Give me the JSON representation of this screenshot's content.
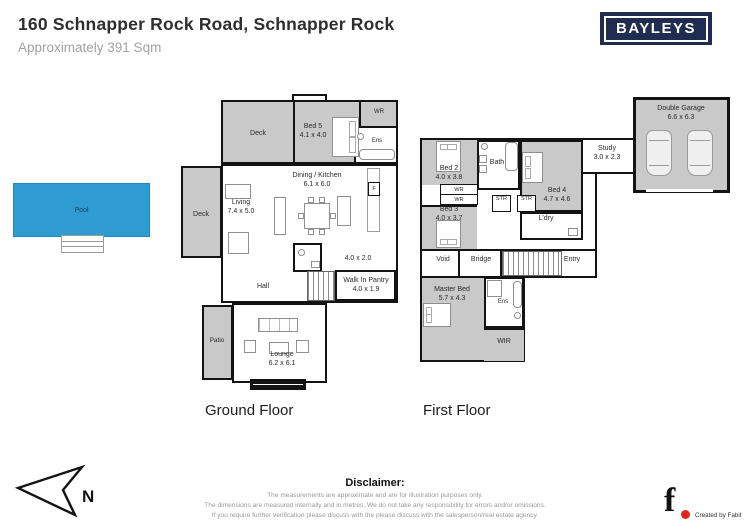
{
  "header": {
    "title": "160 Schnapper Rock Road, Schnapper Rock",
    "subtitle": "Approximately 391 Sqm"
  },
  "logo": {
    "brand": "BAYLEYS"
  },
  "pool": {
    "label": "Pool"
  },
  "gf": {
    "caption": "Ground Floor",
    "rooms": {
      "deck_upper": "Deck",
      "bed5": {
        "name": "Bed 5",
        "dims": "4.1 x 4.0"
      },
      "wr": "WR",
      "ens": "Ens",
      "deck_left": "Deck",
      "living": {
        "name": "Living",
        "dims": "7.4 x 5.0"
      },
      "dining": {
        "name": "Dining / Kitchen",
        "dims": "6.1 x 6.0"
      },
      "fridge": "F",
      "utility_dims": "4.0 x 2.0",
      "pantry": {
        "name": "Walk In Pantry",
        "dims": "4.0 x 1.9"
      },
      "hall": "Hall",
      "patio": "Patio",
      "lounge": {
        "name": "Lounge",
        "dims": "6.2 x 6.1"
      }
    }
  },
  "ff": {
    "caption": "First Floor",
    "rooms": {
      "bed2": {
        "name": "Bed 2",
        "dims": "4.0 x 3.8"
      },
      "bath": "Bath",
      "wr1": "WR",
      "wr2": "WR",
      "bed3": {
        "name": "Bed 3",
        "dims": "4.0 x 3.7"
      },
      "bed4": {
        "name": "Bed 4",
        "dims": "4.7 x 4.6"
      },
      "str1": "STR",
      "str2": "STR",
      "ldry": "L'dry",
      "void": "Void",
      "bridge": "Bridge",
      "entry": "Entry",
      "master": {
        "name": "Master Bed",
        "dims": "5.7 x 4.3"
      },
      "ens": "Ens",
      "wir": "WIR",
      "study": {
        "name": "Study",
        "dims": "3.0 x 2.3"
      },
      "garage": {
        "name": "Double Garage",
        "dims": "6.6 x 6.3"
      }
    }
  },
  "compass": {
    "label": "N"
  },
  "disclaimer": {
    "heading": "Disclaimer:",
    "lines": [
      "The measurements are approximate and are for illustration purposes only.",
      "The dimensions are measured internally and in metres. We do not take any responsibility for errors and/or omissions.",
      "If you require further verification please discuss with the please discuss with the salesperson/real estate agency."
    ]
  },
  "credit": {
    "glyph": "f",
    "text": "Created by Fabit"
  },
  "colors": {
    "plan_gray": "#c9c9c9",
    "wall": "#131313",
    "pool_blue": "#2e9bd3",
    "brand_navy": "#202c50",
    "accent_red": "#e1251b"
  }
}
